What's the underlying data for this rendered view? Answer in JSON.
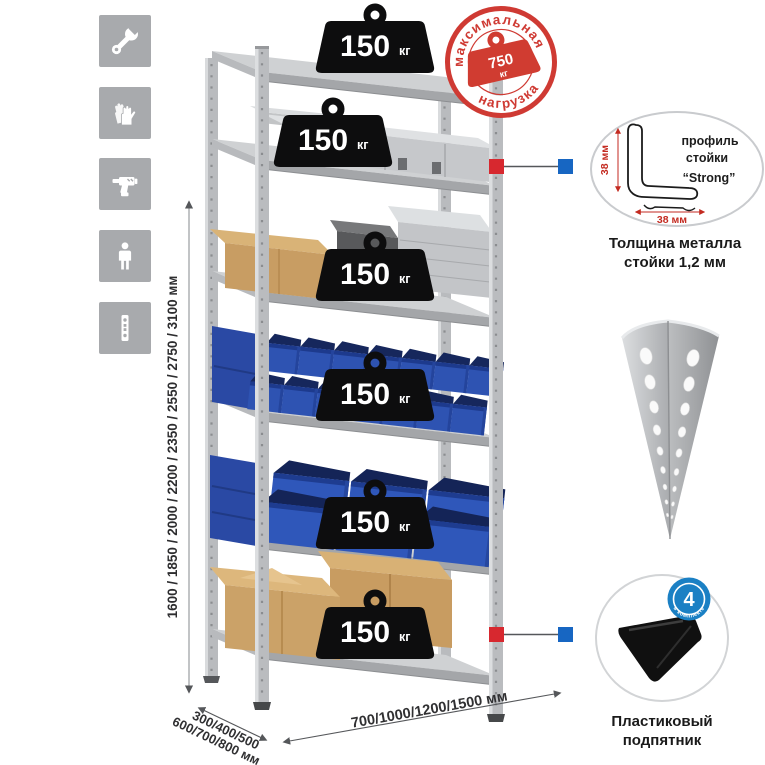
{
  "colors": {
    "stamp_red": "#cf3a33",
    "connector_red": "#d7282f",
    "connector_blue": "#1766c2",
    "badge_blue": "#1b80c4",
    "icon_tile_gray": "#a8aaad",
    "bin_blue": "#2e53b2",
    "cardboard_tan": "#c89c61",
    "metal_gray": "#c6c8ca",
    "dimension_red": "#c32a20"
  },
  "left_icons": {
    "items": [
      {
        "name": "wrench-icon"
      },
      {
        "name": "gloves-icon"
      },
      {
        "name": "drill-icon"
      },
      {
        "name": "person-icon"
      },
      {
        "name": "upright-profile-icon"
      }
    ]
  },
  "height_dimension": {
    "label": "1600 / 1850 / 2000 / 2200 / 2350 / 2550 / 2750 / 3100 мм"
  },
  "max_load_stamp": {
    "arc_top": "максимальная",
    "arc_bottom": "нагрузка",
    "value": "750",
    "unit": "кг"
  },
  "shelf_weights": {
    "items": [
      {
        "value": "150",
        "unit": "кг"
      },
      {
        "value": "150",
        "unit": "кг"
      },
      {
        "value": "150",
        "unit": "кг"
      },
      {
        "value": "150",
        "unit": "кг"
      },
      {
        "value": "150",
        "unit": "кг"
      },
      {
        "value": "150",
        "unit": "кг"
      }
    ]
  },
  "profile_detail": {
    "label_line1": "профиль",
    "label_line2": "стойки",
    "label_line3": "“Strong”",
    "dim_side": "38 мм",
    "dim_bottom": "38 мм",
    "caption_line1": "Толщина металла",
    "caption_line2": "стойки 1,2 мм"
  },
  "kit_badge": {
    "value": "4",
    "arc_text": "в комплекте"
  },
  "foot_detail": {
    "caption_line1": "Пластиковый",
    "caption_line2": "подпятник"
  },
  "depth_dimension": {
    "line1": "300/400/500",
    "line2": "600/700/800 мм"
  },
  "width_dimension": {
    "label": "700/1000/1200/1500 мм"
  }
}
